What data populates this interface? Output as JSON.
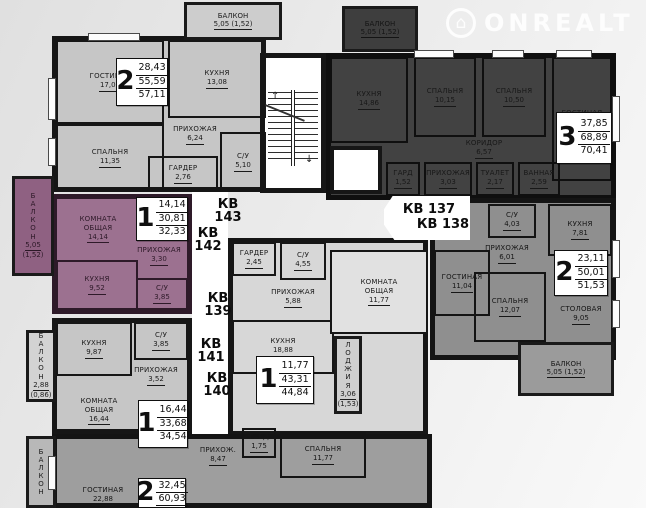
{
  "watermark": {
    "label": "ONREALT",
    "house_icon": "⌂"
  },
  "icons": {
    "stairs_up": "↑",
    "stairs_down": "↓"
  },
  "kv_labels": [
    {
      "lines": [
        "КВ",
        "143"
      ],
      "x": 210,
      "y": 198,
      "w": 36
    },
    {
      "lines": [
        "КВ",
        "142"
      ],
      "x": 190,
      "y": 227,
      "w": 36
    },
    {
      "lines": [
        "КВ",
        "139"
      ],
      "x": 200,
      "y": 292,
      "w": 36
    },
    {
      "lines": [
        "КВ",
        "141"
      ],
      "x": 193,
      "y": 338,
      "w": 36
    },
    {
      "lines": [
        "КВ",
        "140"
      ],
      "x": 199,
      "y": 372,
      "w": 36
    },
    {
      "lines": [
        "КВ 137"
      ],
      "x": 398,
      "y": 203,
      "w": 62
    },
    {
      "lines": [
        "КВ 138"
      ],
      "x": 412,
      "y": 218,
      "w": 62
    }
  ],
  "apartments": [
    {
      "fill": "#c6c6c6",
      "text": "#1a1a1a",
      "wall": "#161616",
      "x": 52,
      "y": 36,
      "w": 214,
      "h": 156,
      "info": {
        "num": "2",
        "values": [
          "28,43",
          "55,59",
          "57,11"
        ],
        "x": 116,
        "y": 58,
        "w": 52,
        "h": 48
      },
      "rooms": [
        {
          "label": "ГОСТИНАЯ",
          "area": "17,08",
          "x": 56,
          "y": 40,
          "w": 108,
          "h": 84,
          "walled": true
        },
        {
          "label": "КУХНЯ",
          "area": "13,08",
          "x": 168,
          "y": 40,
          "w": 98,
          "h": 78,
          "walled": true
        },
        {
          "label": "СПАЛЬНЯ",
          "area": "11,35",
          "x": 56,
          "y": 124,
          "w": 108,
          "h": 68,
          "walled": true
        },
        {
          "label": "ПРИХОЖАЯ",
          "area": "6,24",
          "x": 166,
          "y": 114,
          "w": 58,
          "h": 42,
          "walled": false
        },
        {
          "label": "ГАРДЕР",
          "area": "2,76",
          "x": 148,
          "y": 156,
          "w": 70,
          "h": 36,
          "walled": true
        },
        {
          "label": "С/У",
          "area": "5,10",
          "x": 220,
          "y": 132,
          "w": 46,
          "h": 60,
          "walled": true
        }
      ]
    },
    {
      "fill": "#424242",
      "text": "#181818",
      "wall": "#0f0f0f",
      "x": 326,
      "y": 53,
      "w": 290,
      "h": 147,
      "info": {
        "num": "3",
        "values": [
          "37,85",
          "68,89",
          "70,41"
        ],
        "x": 556,
        "y": 112,
        "w": 56,
        "h": 52
      },
      "rooms": [
        {
          "label": "КУХНЯ",
          "area": "14,86",
          "x": 330,
          "y": 57,
          "w": 78,
          "h": 86,
          "walled": true
        },
        {
          "label": "СПАЛЬНЯ",
          "area": "10,15",
          "x": 414,
          "y": 57,
          "w": 62,
          "h": 80,
          "walled": true
        },
        {
          "label": "СПАЛЬНЯ",
          "area": "10,50",
          "x": 482,
          "y": 57,
          "w": 64,
          "h": 80,
          "walled": true
        },
        {
          "label": "ГОСТИНАЯ",
          "area": "17,20",
          "x": 552,
          "y": 57,
          "w": 60,
          "h": 124,
          "walled": true
        },
        {
          "label": "КОРИДОР",
          "area": "6,57",
          "x": 424,
          "y": 138,
          "w": 120,
          "h": 22,
          "walled": false
        },
        {
          "label": "ГАРД",
          "area": "1,52",
          "x": 386,
          "y": 162,
          "w": 34,
          "h": 34,
          "walled": true
        },
        {
          "label": "ПРИХОЖАЯ",
          "area": "3,03",
          "x": 424,
          "y": 162,
          "w": 48,
          "h": 34,
          "walled": true
        },
        {
          "label": "ТУАЛЕТ",
          "area": "2,17",
          "x": 476,
          "y": 162,
          "w": 38,
          "h": 34,
          "walled": true
        },
        {
          "label": "ВАННАЯ",
          "area": "2,59",
          "x": 518,
          "y": 162,
          "w": 42,
          "h": 34,
          "walled": true
        }
      ]
    },
    {
      "fill": "#9c7190",
      "text": "#2e1a29",
      "wall": "#2e1a29",
      "x": 52,
      "y": 194,
      "w": 140,
      "h": 120,
      "info": {
        "num": "1",
        "values": [
          "14,14",
          "30,81",
          "32,33"
        ],
        "x": 136,
        "y": 197,
        "w": 52,
        "h": 44
      },
      "rooms": [
        {
          "label": "КОМНАТА ОБЩАЯ",
          "area": "14,14",
          "x": 58,
          "y": 200,
          "w": 80,
          "h": 58,
          "walled": false,
          "narrow": true
        },
        {
          "label": "ПРИХОЖАЯ",
          "area": "3,30",
          "x": 130,
          "y": 243,
          "w": 58,
          "h": 26,
          "walled": false
        },
        {
          "label": "КУХНЯ",
          "area": "9,52",
          "x": 56,
          "y": 260,
          "w": 82,
          "h": 50,
          "walled": true
        },
        {
          "label": "С/У",
          "area": "3,85",
          "x": 136,
          "y": 278,
          "w": 52,
          "h": 32,
          "walled": true
        }
      ]
    },
    {
      "fill": "#c6c6c6",
      "text": "#1a1a1a",
      "wall": "#161616",
      "x": 52,
      "y": 318,
      "w": 140,
      "h": 116,
      "info": {
        "num": "1",
        "values": [
          "16,44",
          "33,68",
          "34,54"
        ],
        "x": 138,
        "y": 400,
        "w": 50,
        "h": 48
      },
      "rooms": [
        {
          "label": "КУХНЯ",
          "area": "9,87",
          "x": 56,
          "y": 322,
          "w": 76,
          "h": 54,
          "walled": true
        },
        {
          "label": "С/У",
          "area": "3,85",
          "x": 134,
          "y": 322,
          "w": 54,
          "h": 38,
          "walled": true
        },
        {
          "label": "ПРИХОЖАЯ",
          "area": "3,52",
          "x": 126,
          "y": 362,
          "w": 60,
          "h": 28,
          "walled": false
        },
        {
          "label": "КОМНАТА ОБЩАЯ",
          "area": "16,44",
          "x": 58,
          "y": 390,
          "w": 82,
          "h": 42,
          "walled": false,
          "narrow": true
        }
      ]
    },
    {
      "fill": "#d7d7d7",
      "text": "#1a1a1a",
      "wall": "#161616",
      "x": 228,
      "y": 238,
      "w": 200,
      "h": 198,
      "info": {
        "num": "1",
        "values": [
          "11,77",
          "43,31",
          "44,84"
        ],
        "x": 256,
        "y": 356,
        "w": 58,
        "h": 48
      },
      "rooms": [
        {
          "label": "ГАРДЕР",
          "area": "2,45",
          "x": 232,
          "y": 242,
          "w": 44,
          "h": 34,
          "walled": true
        },
        {
          "label": "С/У",
          "area": "4,55",
          "x": 280,
          "y": 242,
          "w": 46,
          "h": 38,
          "walled": true
        },
        {
          "label": "ПРИХОЖАЯ",
          "area": "5,88",
          "x": 260,
          "y": 284,
          "w": 66,
          "h": 28,
          "walled": false
        },
        {
          "label": "КУХНЯ",
          "area": "18,88",
          "x": 232,
          "y": 320,
          "w": 102,
          "h": 54,
          "walled": true
        },
        {
          "label": "КОМНАТА ОБЩАЯ",
          "area": "11,77",
          "x": 330,
          "y": 250,
          "w": 98,
          "h": 84,
          "walled": true,
          "narrow": true,
          "fill": "#e1e1e1"
        }
      ]
    },
    {
      "fill": "#8f8f8f",
      "text": "#161616",
      "wall": "#141414",
      "x": 430,
      "y": 198,
      "w": 186,
      "h": 162,
      "info": {
        "num": "2",
        "values": [
          "23,11",
          "50,01",
          "51,53"
        ],
        "x": 554,
        "y": 250,
        "w": 54,
        "h": 46
      },
      "rooms": [
        {
          "label": "С/У",
          "area": "4,03",
          "x": 488,
          "y": 204,
          "w": 48,
          "h": 34,
          "walled": true
        },
        {
          "label": "ПРИХОЖАЯ",
          "area": "6,01",
          "x": 472,
          "y": 240,
          "w": 70,
          "h": 28,
          "walled": false
        },
        {
          "label": "КУХНЯ",
          "area": "7,81",
          "x": 548,
          "y": 204,
          "w": 64,
          "h": 52,
          "walled": true
        },
        {
          "label": "ГОСТИНАЯ",
          "area": "11,04",
          "x": 434,
          "y": 250,
          "w": 56,
          "h": 66,
          "walled": true
        },
        {
          "label": "СПАЛЬНЯ",
          "area": "12,07",
          "x": 474,
          "y": 272,
          "w": 72,
          "h": 70,
          "walled": true
        },
        {
          "label": "СТОЛОВАЯ",
          "area": "9,05",
          "x": 550,
          "y": 286,
          "w": 62,
          "h": 58,
          "walled": false
        }
      ]
    },
    {
      "fill": "#9e9e9e",
      "text": "#161616",
      "wall": "#141414",
      "x": 52,
      "y": 434,
      "w": 380,
      "h": 74,
      "info": {
        "num": "2",
        "values": [
          "32,45",
          "60,93"
        ],
        "ua": true,
        "x": 138,
        "y": 478,
        "w": 48,
        "h": 30
      },
      "rooms": [
        {
          "label": "ПРИХОЖ.",
          "area": "8,47",
          "x": 188,
          "y": 442,
          "w": 60,
          "h": 28,
          "walled": false
        },
        {
          "label": "ГАРД",
          "area": "1,75",
          "x": 242,
          "y": 428,
          "w": 34,
          "h": 30,
          "walled": true
        },
        {
          "label": "СПАЛЬНЯ",
          "area": "11,77",
          "x": 280,
          "y": 432,
          "w": 86,
          "h": 46,
          "walled": true
        },
        {
          "label": "ГОСТИНАЯ",
          "area": "22,88",
          "x": 60,
          "y": 484,
          "w": 86,
          "h": 24,
          "walled": false
        }
      ]
    }
  ],
  "balconies": [
    {
      "label": "БАЛКОН",
      "areas": [
        "5,05 (1,52)"
      ],
      "x": 184,
      "y": 2,
      "w": 98,
      "h": 38,
      "vertical": false,
      "fill": "#cdcdcd",
      "text": "#1c1c1c"
    },
    {
      "label": "БАЛКОН",
      "areas": [
        "5,05 (1,52)"
      ],
      "x": 342,
      "y": 6,
      "w": 76,
      "h": 46,
      "vertical": false,
      "fill": "#3e3e3e",
      "text": "#141414"
    },
    {
      "label": "БАЛКОН",
      "areas": [
        "5,05",
        "(1,52)"
      ],
      "x": 12,
      "y": 176,
      "w": 42,
      "h": 100,
      "vertical": true,
      "fill": "#8f6182",
      "text": "#2c1827"
    },
    {
      "label": "БАЛКОН",
      "areas": [
        "2,88",
        "(0,86)"
      ],
      "x": 26,
      "y": 330,
      "w": 30,
      "h": 72,
      "vertical": true,
      "fill": "#d3d3d3",
      "text": "#1c1c1c"
    },
    {
      "label": "ЛОДЖИЯ",
      "areas": [
        "3,06",
        "(1,53)"
      ],
      "x": 334,
      "y": 336,
      "w": 28,
      "h": 78,
      "vertical": true,
      "fill": "#cfcfcf",
      "text": "#1c1c1c"
    },
    {
      "label": "БАЛКОН",
      "areas": [
        "5,05 (1,52)"
      ],
      "x": 518,
      "y": 342,
      "w": 96,
      "h": 54,
      "vertical": false,
      "fill": "#9b9b9b",
      "text": "#161616"
    },
    {
      "label": "БАЛКОН",
      "areas": [],
      "x": 26,
      "y": 436,
      "w": 30,
      "h": 72,
      "vertical": true,
      "fill": "#b8b8b8",
      "text": "#1c1c1c"
    }
  ]
}
